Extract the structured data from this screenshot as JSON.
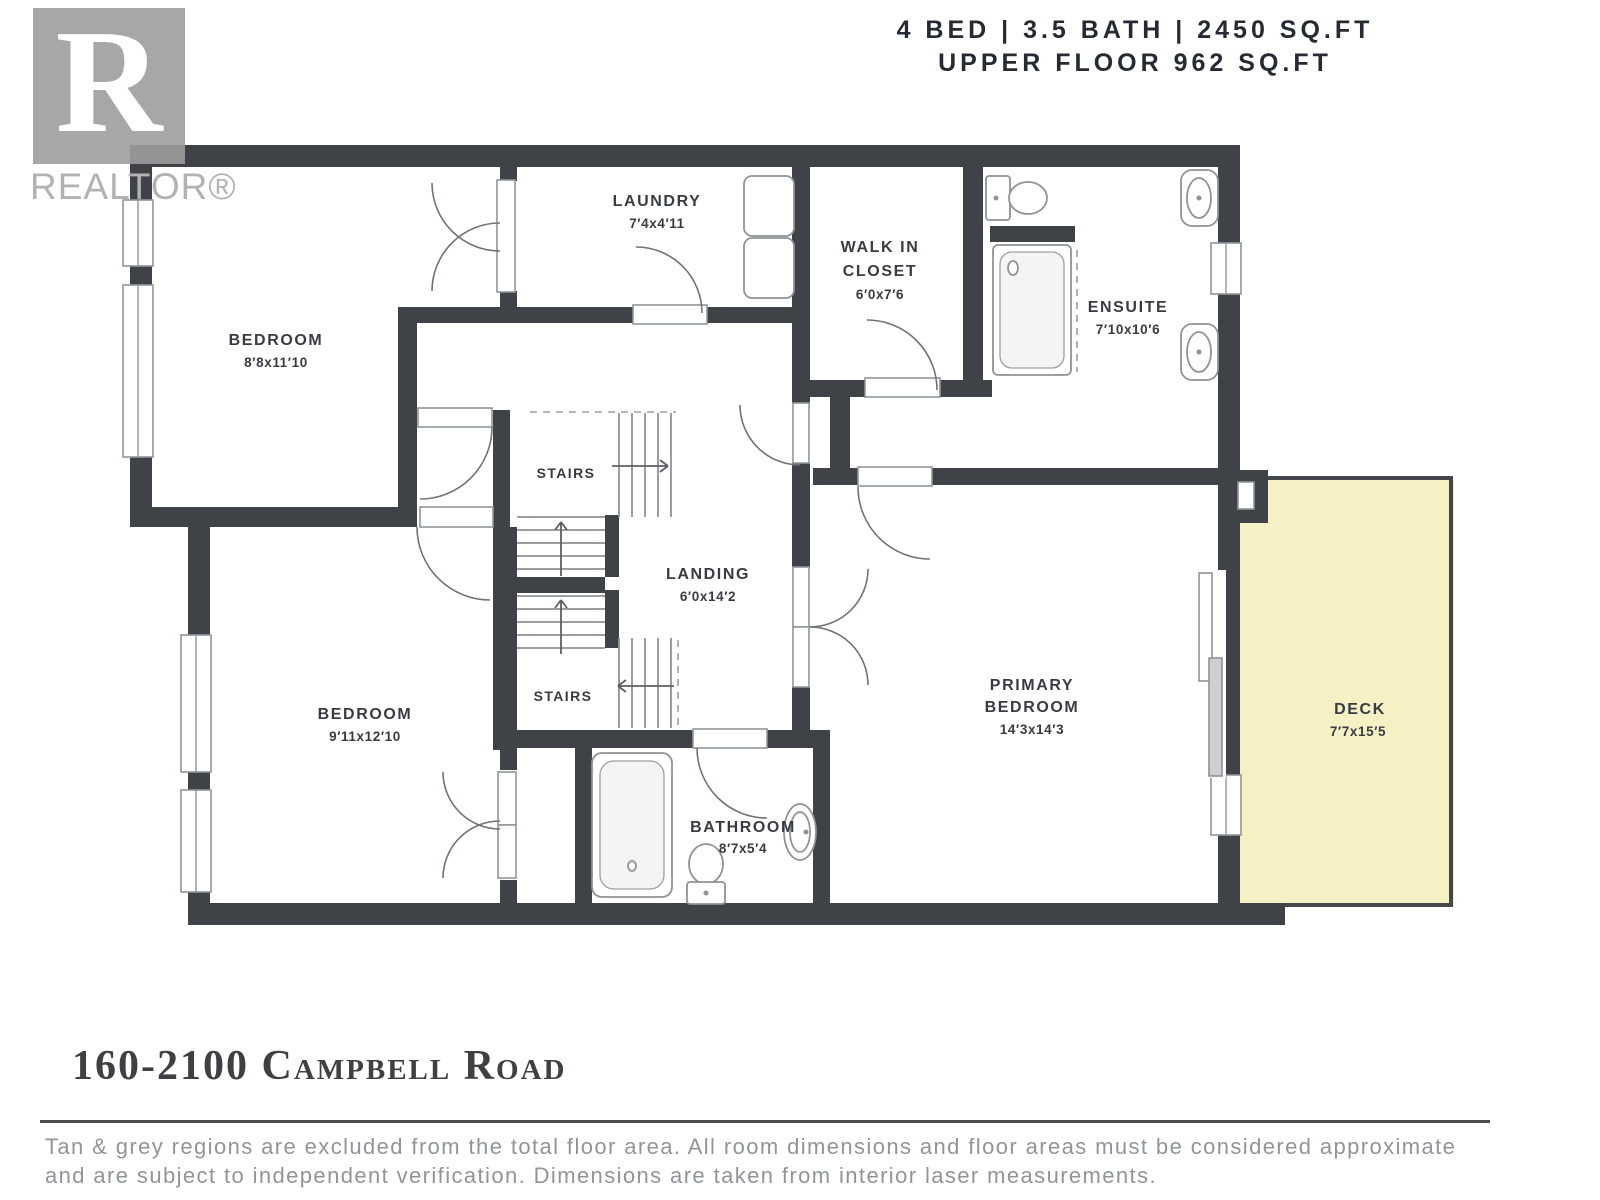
{
  "header": {
    "line1": "4 BED | 3.5 BATH | 2450 SQ.FT",
    "line2": "UPPER FLOOR 962 SQ.FT"
  },
  "logo": {
    "letter": "R",
    "wordmark": "REALTOR®"
  },
  "rooms": {
    "bedroom_top": {
      "name": "BEDROOM",
      "dims": "8′8x11′10"
    },
    "laundry": {
      "name": "LAUNDRY",
      "dims": "7′4x4′11"
    },
    "walk_in_closet": {
      "name1": "WALK IN",
      "name2": "CLOSET",
      "dims": "6′0x7′6"
    },
    "ensuite": {
      "name": "ENSUITE",
      "dims": "7′10x10′6"
    },
    "stairs_upper": {
      "name": "STAIRS"
    },
    "stairs_lower": {
      "name": "STAIRS"
    },
    "landing": {
      "name": "LANDING",
      "dims": "6′0x14′2"
    },
    "bedroom_lower": {
      "name": "BEDROOM",
      "dims": "9′11x12′10"
    },
    "bathroom": {
      "name": "BATHROOM",
      "dims": "8′7x5′4"
    },
    "primary_bedroom": {
      "name1": "PRIMARY",
      "name2": "BEDROOM",
      "dims": "14′3x14′3"
    },
    "deck": {
      "name": "DECK",
      "dims": "7′7x15′5"
    }
  },
  "footer": {
    "address": "160-2100 Campbell Road",
    "disclaimer_line1": "Tan & grey regions are excluded from the total floor area. All room dimensions and floor areas must be considered approximate",
    "disclaimer_line2": "and are subject to independent verification. Dimensions are taken from interior laser measurements."
  },
  "colors": {
    "wall": "#3f4246",
    "deck_fill": "#f6f0c5",
    "label": "#383c42",
    "logo_grey": "#9d9d9d",
    "stroke_grey": "#8f9396"
  }
}
